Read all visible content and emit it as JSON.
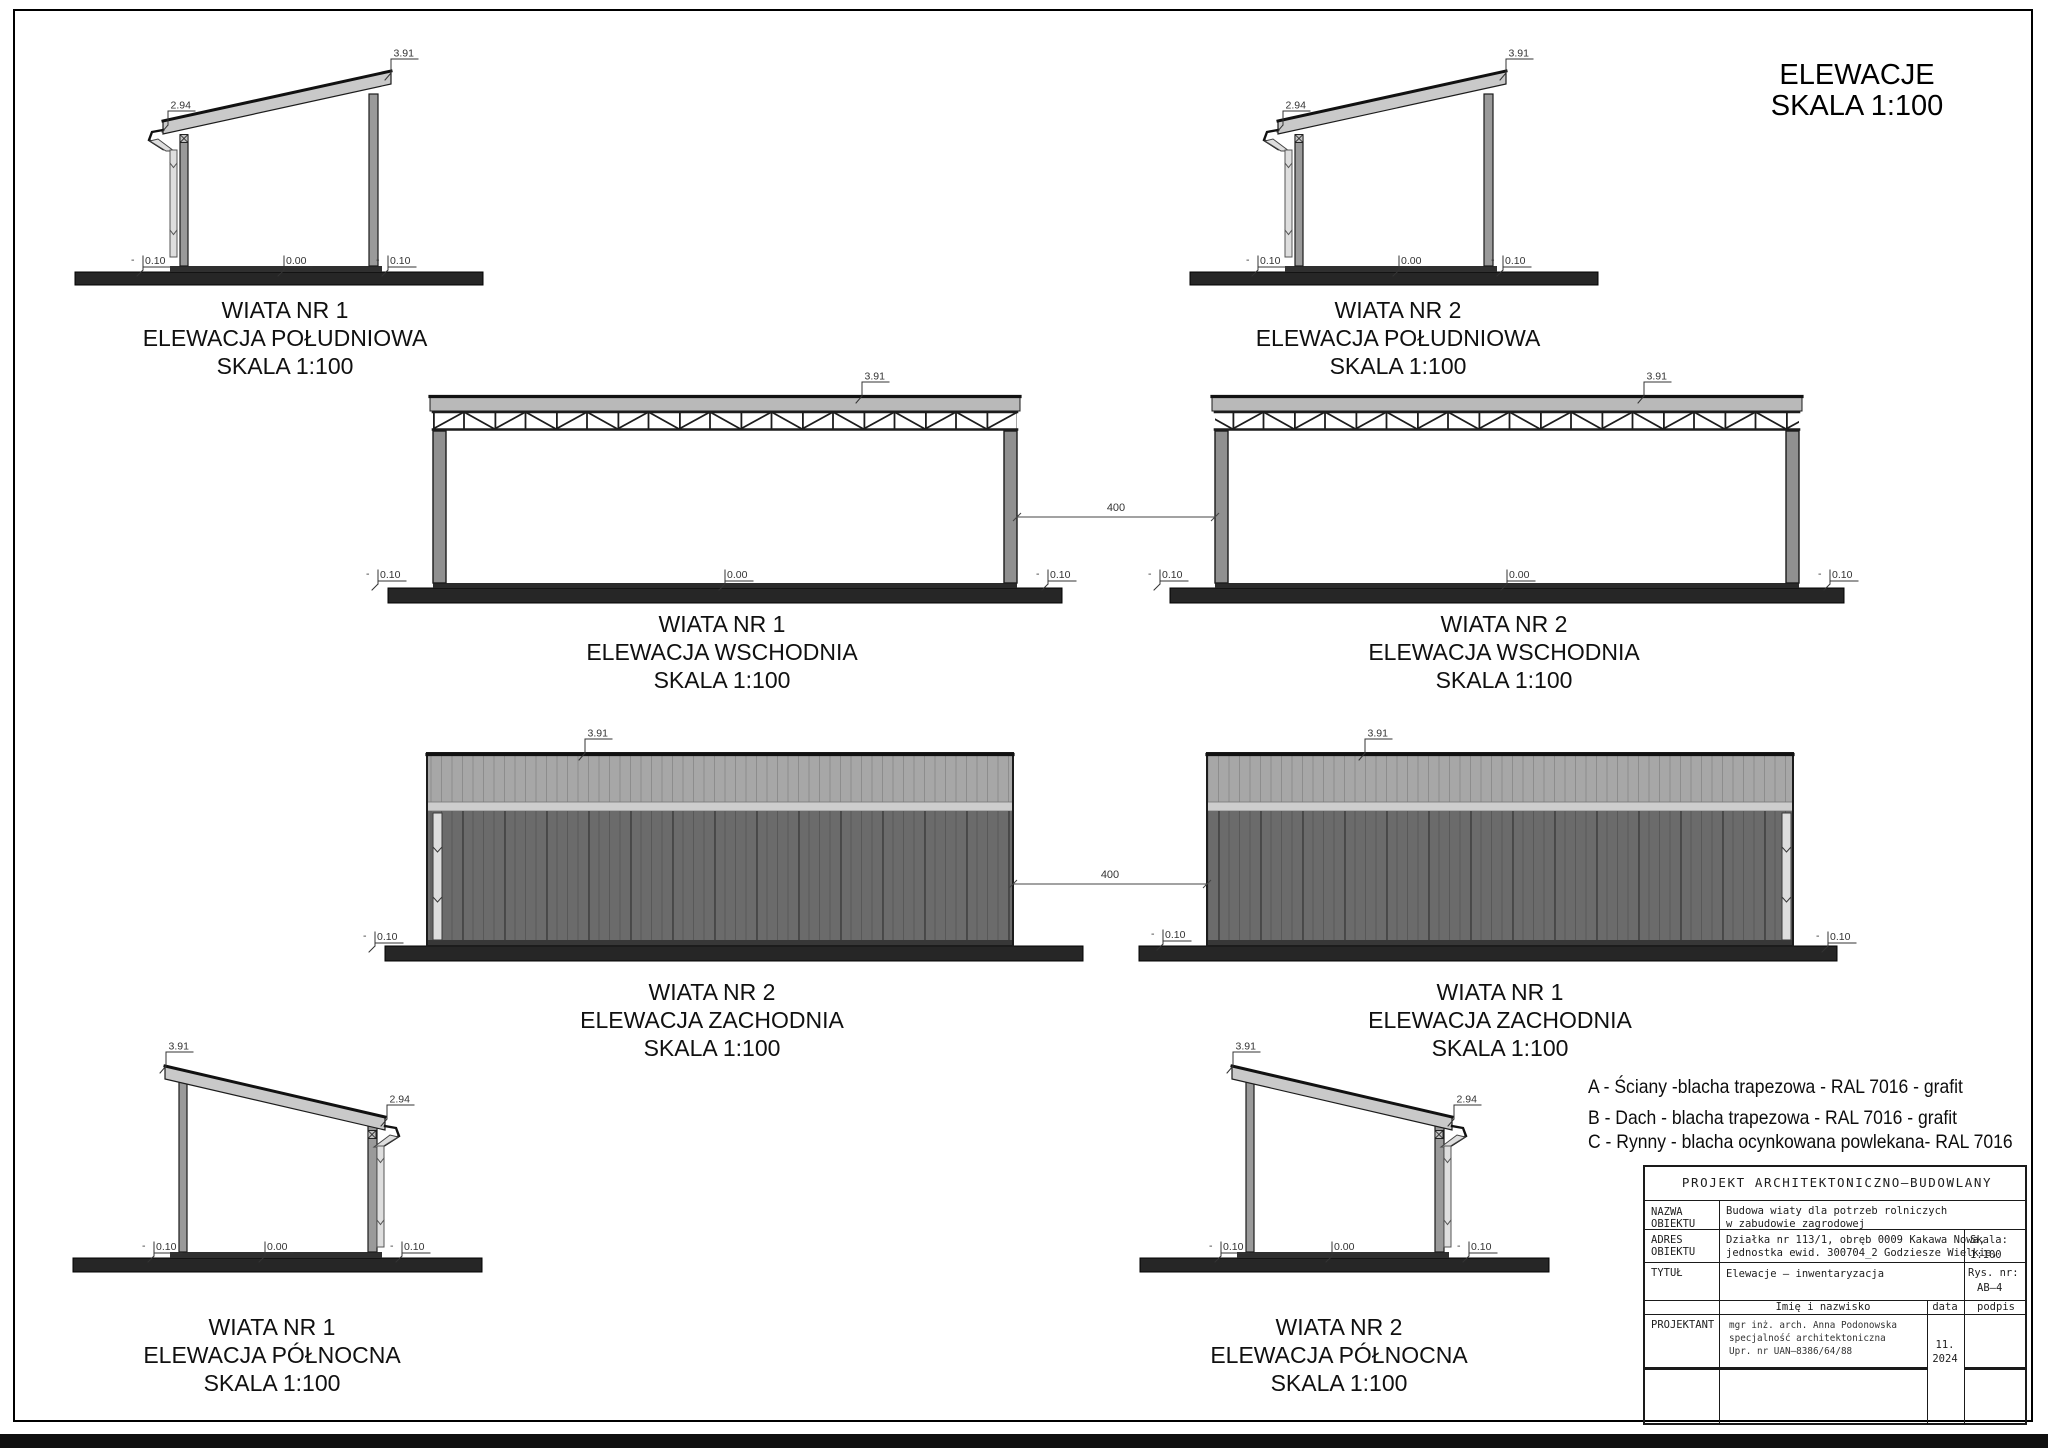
{
  "sheet": {
    "title_line1": "ELEWACJE",
    "title_line2": "SKALA 1:100"
  },
  "dims": {
    "top": "3.91",
    "eave": "2.94",
    "zero": "0.00",
    "ground": "0.10",
    "minus": "-",
    "gap": "400"
  },
  "elevations": {
    "s1": {
      "line1": "WIATA NR 1",
      "line2": "ELEWACJA POŁUDNIOWA",
      "line3": "SKALA 1:100"
    },
    "s2": {
      "line1": "WIATA NR 2",
      "line2": "ELEWACJA POŁUDNIOWA",
      "line3": "SKALA 1:100"
    },
    "e1": {
      "line1": "WIATA NR 1",
      "line2": "ELEWACJA WSCHODNIA",
      "line3": "SKALA 1:100"
    },
    "e2": {
      "line1": "WIATA NR 2",
      "line2": "ELEWACJA WSCHODNIA",
      "line3": "SKALA 1:100"
    },
    "w2": {
      "line1": "WIATA NR 2",
      "line2": "ELEWACJA ZACHODNIA",
      "line3": "SKALA 1:100"
    },
    "w1": {
      "line1": "WIATA NR 1",
      "line2": "ELEWACJA ZACHODNIA",
      "line3": "SKALA 1:100"
    },
    "n1": {
      "line1": "WIATA NR 1",
      "line2": "ELEWACJA PÓŁNOCNA",
      "line3": "SKALA 1:100"
    },
    "n2": {
      "line1": "WIATA NR 2",
      "line2": "ELEWACJA PÓŁNOCNA",
      "line3": "SKALA 1:100"
    }
  },
  "legend": {
    "a": "A - Ściany -blacha trapezowa - RAL 7016 - grafit",
    "b": "B - Dach - blacha trapezowa - RAL 7016 - grafit",
    "c": "C - Rynny - blacha ocynkowana powlekana- RAL 7016"
  },
  "titleblock": {
    "header": "PROJEKT ARCHITEKTONICZNO–BUDOWLANY",
    "nazwa_label_1": "NAZWA",
    "nazwa_label_2": "OBIEKTU",
    "nazwa_value_1": "Budowa wiaty dla potrzeb rolniczych",
    "nazwa_value_2": "w zabudowie zagrodowej",
    "adres_label_1": "ADRES",
    "adres_label_2": "OBIEKTU",
    "adres_value_1": "Działka nr 113/1, obręb 0009 Kakawa Nowa,",
    "adres_value_2": "jednostka ewid. 300704_2 Godziesze Wielkie,",
    "skala_label": "Skala:",
    "skala_value": "1:100",
    "tytul_label": "TYTUŁ",
    "tytul_value": "Elewacje – inwentaryzacja",
    "rys_label": "Rys. nr:",
    "rys_value": "AB–4",
    "imie_header": "Imię i nazwisko",
    "data_header": "data",
    "podpis_header": "podpis",
    "projektant_label": "PROJEKTANT",
    "projektant_line_1": "mgr inż. arch. Anna Podonowska",
    "projektant_line_2": "specjalność architektoniczna",
    "projektant_line_3": "Upr. nr UAN–8386/64/88",
    "date_line_1": "11.",
    "date_line_2": "2024"
  },
  "colors": {
    "wall": "#6b6b6b",
    "roof_band": "#b9b9b9",
    "steel_column": "#9a9a9a",
    "gutter_pipe": "#dedede",
    "ground": "#262626",
    "line": "#1c1c1c"
  }
}
